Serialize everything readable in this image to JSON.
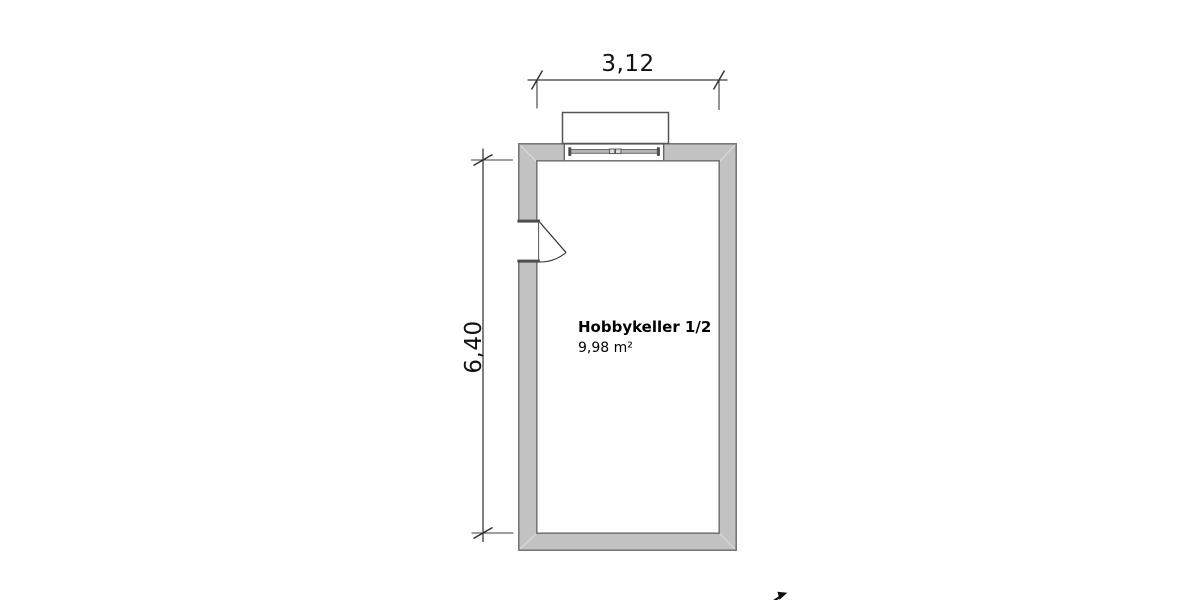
{
  "plan": {
    "room": {
      "name": "Hobbykeller 1/2",
      "area": "9,98 m²"
    },
    "dimensions": {
      "width_label": "3,12",
      "height_label": "6,40"
    },
    "features": {
      "window": "window-symbol-top-wall",
      "door": "door-swing-left-wall"
    },
    "colors": {
      "background": "#ffffff",
      "wall_fill": "#c2c2c2",
      "wall_outline": "#777777",
      "wall_miter": "#d8d8d8",
      "dimension_line": "#3c3c3c",
      "text": "#111111"
    }
  }
}
